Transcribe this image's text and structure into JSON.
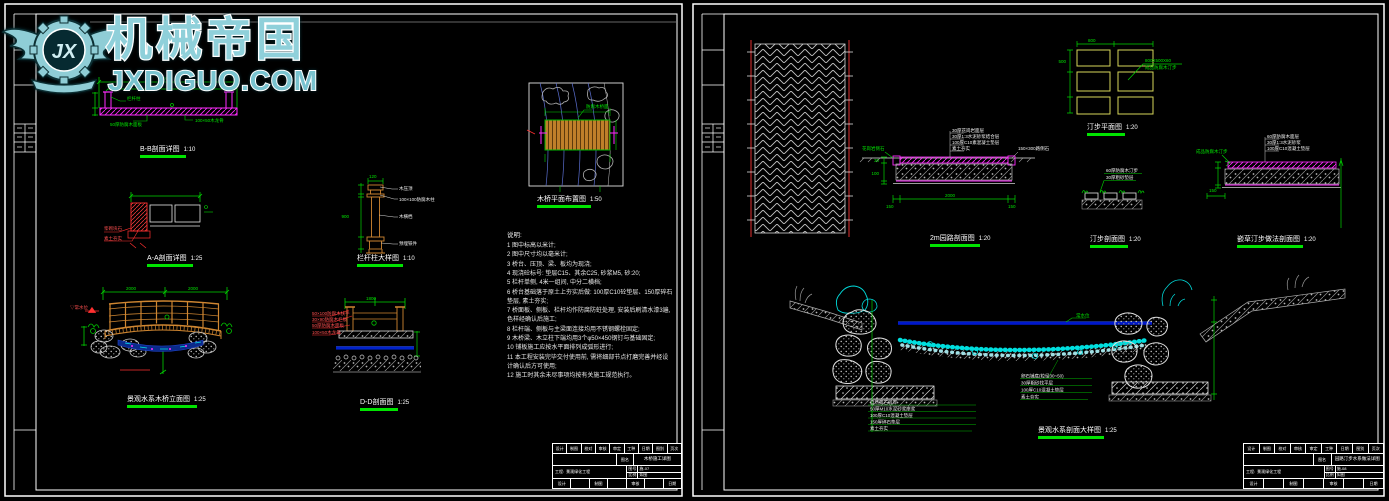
{
  "colors": {
    "background": "#000000",
    "frame_white": "#ffffff",
    "dimension_green": "#00d400",
    "label_underline_green": "#00e400",
    "detail_magenta": "#ff2bff",
    "detail_red": "#ff3030",
    "wood_orange": "#cf8631",
    "stone_yellow": "#d6d65a",
    "water_blue": "#0018cc",
    "pebble_cyan": "#00dede",
    "rock_gray": "#9a9a9a",
    "watermark_teal": "#8fd0da"
  },
  "watermark": {
    "brand": "机械帝国",
    "site": "JXDIGUO.COM",
    "logo": "JX"
  },
  "left": {
    "labels": [
      {
        "text": "B-B剖面详图",
        "scale": "1:10"
      },
      {
        "text": "A-A剖面详图",
        "scale": "1:25"
      },
      {
        "text": "栏杆柱大样图",
        "scale": "1:10"
      },
      {
        "text": "景观水系木桥立面图",
        "scale": "1:25"
      },
      {
        "text": "D-D剖面图",
        "scale": "1:25"
      },
      {
        "text": "木桥平面布置图",
        "scale": "1:50"
      }
    ],
    "bb_dim": "3500",
    "bb_callouts": [
      "栏杆柱",
      "50厚防腐木面板",
      "100×50木龙骨"
    ],
    "aa_callouts": [
      "浆砌块石",
      "素土夯实"
    ],
    "post_dim_w": "120",
    "post_dim_h": "900",
    "post_callouts": [
      "木压顶",
      "100×100防腐木柱",
      "木横档",
      "预埋铁件"
    ],
    "elev_dim_left": "2000",
    "elev_dim_right": "2000",
    "elev_level": "▽常水位",
    "dd_dim": "1800",
    "dd_callouts": [
      "50×100防腐木扶手",
      "30×90防腐木栏板",
      "50厚防腐木面板",
      "100×50木龙骨"
    ],
    "plan_note": "防腐木桥面",
    "notes_title": "说明:",
    "notes": [
      "1 图中标高以米计;",
      "2 图中尺寸均以毫米计;",
      "3 桥台、压顶、梁、板均为现浇;",
      "4 现浇砼标号: 垫层C15、其余C25, 砂浆M5, 砂:20;",
      "5 栏杆单侧, 4米一组间, 中分二横档;",
      "6 桥台基础落于原土上夯实后做: 100厚C10砼垫层、150厚碎石垫层, 素土夯实;",
      "7 桥面板、侧板、栏杆均作防腐防蛀处理, 安装后刷清水漆3遍, 色样经确认后施工;",
      "8 栏杆端、侧板与主梁面连接均用不锈钢螺栓固定;",
      "9 木桥梁、木立柱下端均用3个φ50×450钢钉与基础固定;",
      "10 铺板施工应按水平面排列成弧形进行;",
      "11 本工程安装完毕交付使用前, 需将细部节点打磨完善并经设计确认后方可使用;",
      "12 施工时其余未尽事项均按有关施工规范执行。"
    ],
    "titleblock": {
      "top": [
        "设计",
        "制图",
        "校对",
        "审核",
        "审定",
        "工种",
        "日期",
        "图别",
        "页次"
      ],
      "name_label": "图名",
      "name_value": "木桥施工详图",
      "project_label": "工程:",
      "project_value": "景观绿化工程",
      "no_label": "图号",
      "no_value": "施-07",
      "scale_label": "比例",
      "scale_value": "如图",
      "bottom": [
        "设计",
        "",
        "制图",
        "",
        "审核",
        "",
        "日期"
      ]
    }
  },
  "right": {
    "labels": [
      {
        "text": "汀步平面图",
        "scale": "1:20"
      },
      {
        "text": "2m园路剖面图",
        "scale": "1:20"
      },
      {
        "text": "汀步剖面图",
        "scale": "1:20"
      },
      {
        "text": "嵌草汀步做法剖面图",
        "scale": "1:20"
      },
      {
        "text": "景观水系剖面大样图",
        "scale": "1:25"
      }
    ],
    "tingbu_note1": "800X500X60",
    "tingbu_note2": "成品防腐木汀步",
    "tingbu_dim_w": "800",
    "tingbu_dim_h": "500",
    "road_callouts": [
      "30厚花岗岩面层",
      "30厚1:3水泥砂浆结合层",
      "100厚C10素混凝土垫层",
      "素土夯实"
    ],
    "road_layer_dims": [
      "30",
      "100"
    ],
    "road_dims": [
      "150",
      "2000",
      "150"
    ],
    "road_left_note": "花岗岩侧石",
    "road_right_note": "150×300路侧石",
    "tingbu_sec_callouts": [
      "60厚防腐木汀步",
      "30厚粗砂垫层"
    ],
    "qiancao_callouts": [
      "60厚防腐木面层",
      "30厚1:3水泥砂浆",
      "100厚C10混凝土垫层"
    ],
    "qiancao_left_note": "成品防腐木汀步",
    "qiancao_dim": "150",
    "water_label": "常水位",
    "stream_left_callouts": [
      "自然景石驳岸",
      "50厚M10水泥砂浆座浆",
      "100厚C10混凝土垫层",
      "150厚碎石垫层",
      "素土夯实"
    ],
    "stream_right_callouts": [
      "卵石铺底(粒径30~50)",
      "30厚粗砂找平层",
      "100厚C10混凝土垫层",
      "素土夯实"
    ],
    "titleblock": {
      "top": [
        "设计",
        "制图",
        "校对",
        "审核",
        "审定",
        "工种",
        "日期",
        "图别",
        "页次"
      ],
      "name_label": "图名",
      "name_value": "园路汀步水系做法详图",
      "project_label": "工程:",
      "project_value": "景观绿化工程",
      "no_label": "图号",
      "no_value": "施-08",
      "scale_label": "比例",
      "scale_value": "如图",
      "bottom": [
        "设计",
        "",
        "制图",
        "",
        "审核",
        "",
        "日期"
      ]
    }
  }
}
